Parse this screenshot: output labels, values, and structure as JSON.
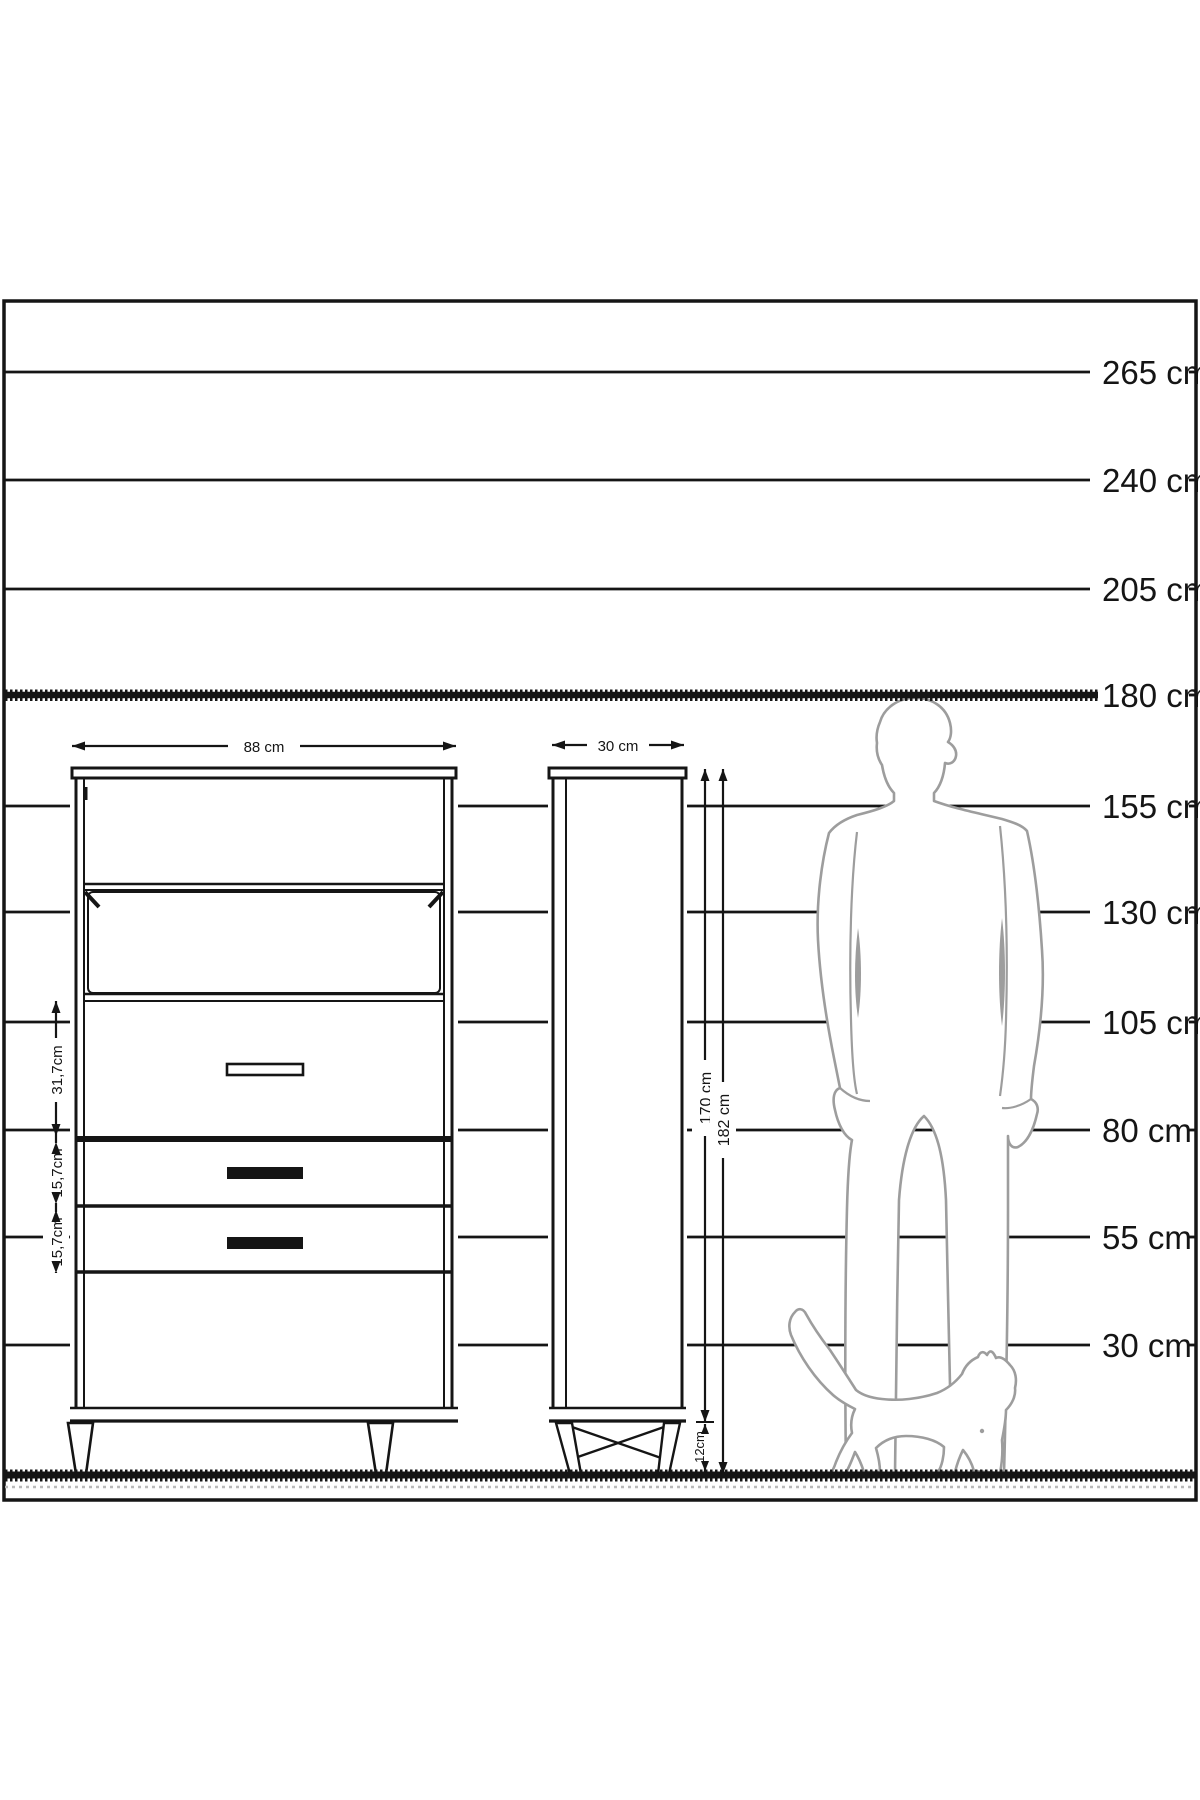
{
  "diagram": {
    "title": "furniture-height-comparison-diagram",
    "unit": "cm",
    "colors": {
      "line": "#151515",
      "silhouette": "#9d9d9d",
      "background": "#ffffff"
    },
    "height_scale": {
      "labels": [
        "265 cm",
        "240 cm",
        "205 cm",
        "180 cm",
        "155 cm",
        "130 cm",
        "105 cm",
        "80 cm",
        "55 cm",
        "30 cm"
      ],
      "values": [
        265,
        240,
        205,
        180,
        155,
        130,
        105,
        80,
        55,
        30
      ],
      "highlighted_value": 180
    },
    "front_view": {
      "width_label": "88 cm",
      "width_cm": 88,
      "sections": [
        {
          "label": "31,7cm",
          "value_cm": 31.7
        },
        {
          "label": "15,7cm",
          "value_cm": 15.7
        },
        {
          "label": "15,7cm",
          "value_cm": 15.7
        }
      ]
    },
    "side_view": {
      "depth_label": "30 cm",
      "depth_cm": 30,
      "body_height_label": "170 cm",
      "body_height_cm": 170,
      "total_height_label": "182 cm",
      "total_height_cm": 182,
      "leg_height_label": "12cm",
      "leg_height_cm": 12
    },
    "figures": {
      "man": "standing-man-silhouette",
      "cat": "walking-cat-silhouette"
    }
  }
}
